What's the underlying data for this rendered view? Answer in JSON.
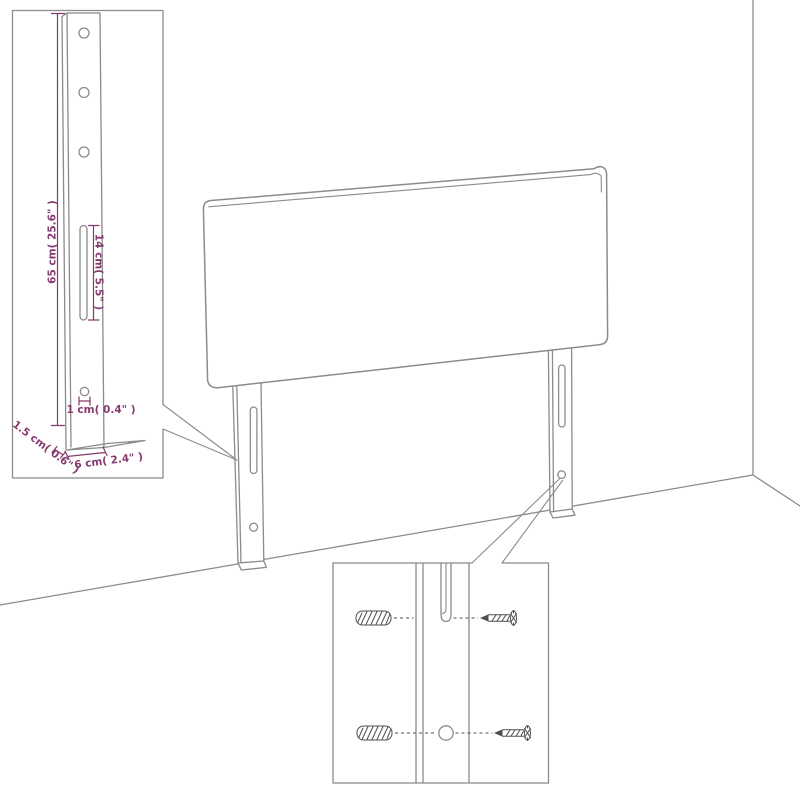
{
  "colors": {
    "outline": "#8b8b8b",
    "hardware": "#4f4f4f",
    "dimension": "#853a6f",
    "background": "#ffffff"
  },
  "leg_dimension_inset": {
    "height_label": "65 cm( 25.6\" )",
    "slot_label": "14 cm( 5.5\" )",
    "hole_label": "1 cm( 0.4\" )",
    "thickness_label": "1.5 cm( 0.6\" )",
    "depth_label": "6 cm( 2.4\" )"
  },
  "hardware_inset": {
    "icons": [
      "wall-anchor-icon",
      "screw-icon",
      "mounting-slot",
      "mounting-hole"
    ]
  }
}
